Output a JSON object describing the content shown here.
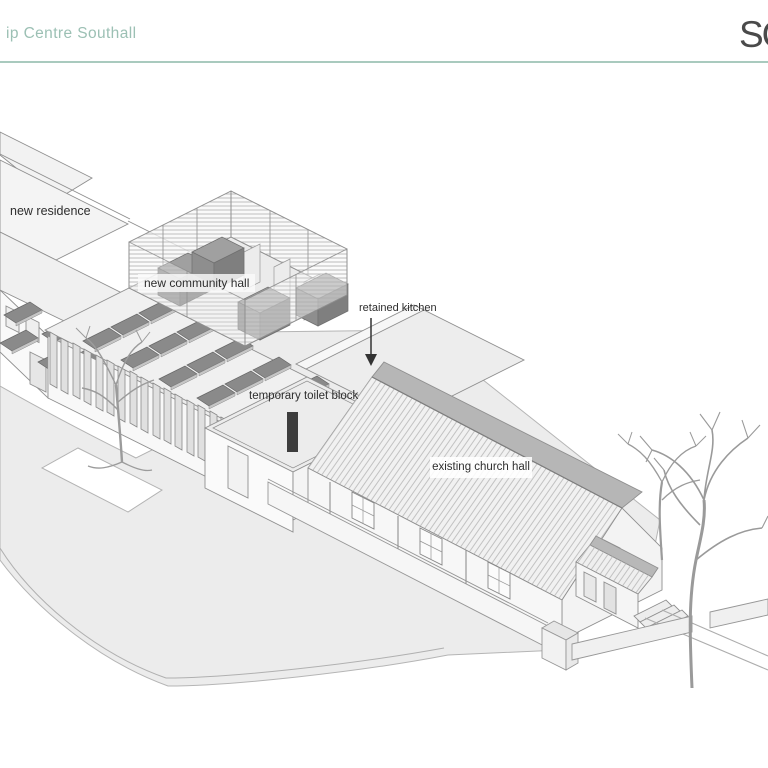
{
  "header": {
    "title": "ip Centre Southall",
    "logo": "SC",
    "accent_color": "#9cc0b4",
    "rule_color": "#a9cabe"
  },
  "labels": {
    "residence": "new residence",
    "community_hall": "new community hall",
    "kitchen": "retained kitchen",
    "toilet": "temporary toilet block",
    "church_hall": "existing church hall"
  },
  "drawing": {
    "style_colors": {
      "linework": "#8f8f8f",
      "ground": "#ececec",
      "roof": "#f1f1f1",
      "solar_panel": "#8a8a8a",
      "roof_ridge_band": "#b6b6b6",
      "marker_bar": "#3d3d3d"
    }
  }
}
